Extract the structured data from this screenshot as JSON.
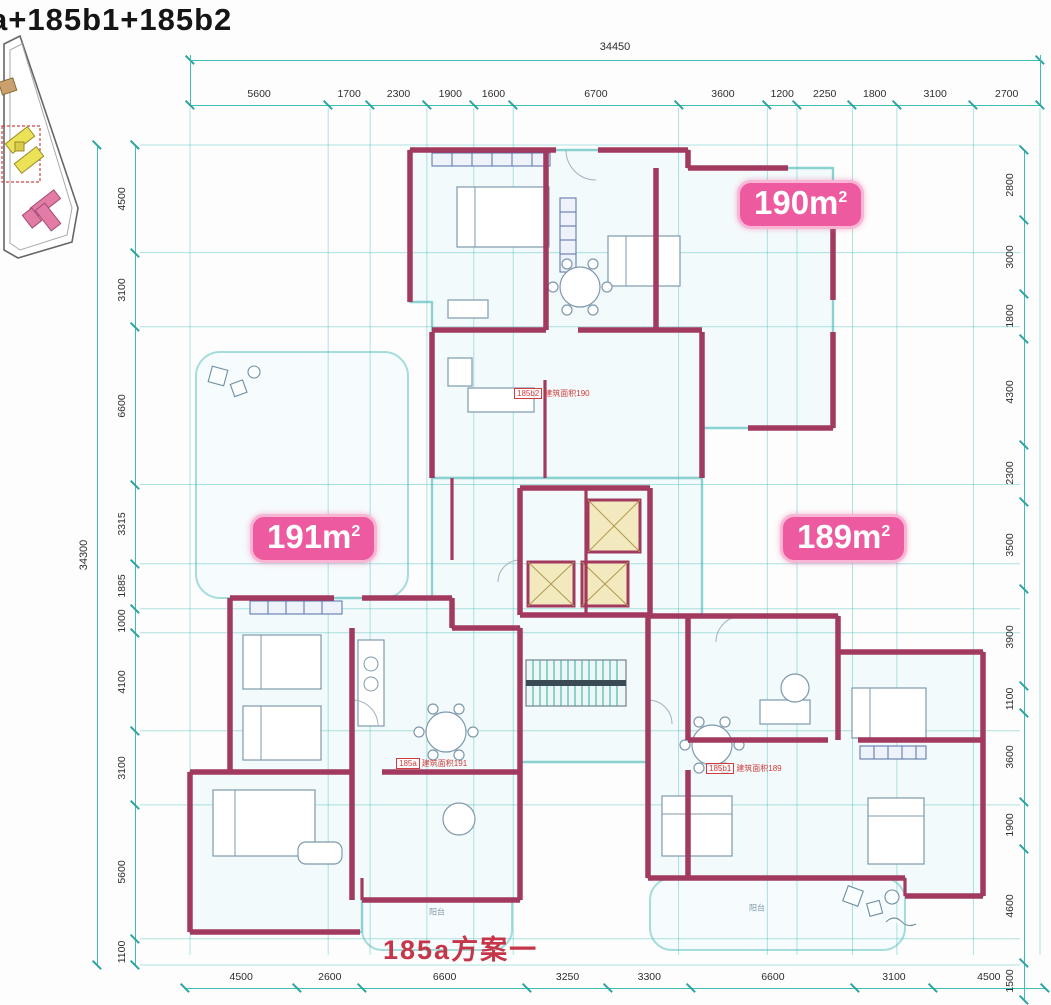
{
  "title": "a+185b1+185b2",
  "plan_name": "185a方案一",
  "badges": [
    {
      "text": "190m",
      "sup": "2"
    },
    {
      "text": "191m",
      "sup": "2"
    },
    {
      "text": "189m",
      "sup": "2"
    }
  ],
  "dimensions": {
    "top": {
      "total": 34450,
      "segments": [
        5600,
        1700,
        2300,
        1900,
        1600,
        6700,
        3600,
        1200,
        2250,
        1800,
        3100,
        2700
      ]
    },
    "bottom": {
      "segments": [
        4500,
        2600,
        6600,
        3250,
        3300,
        6600,
        3100,
        4500
      ]
    },
    "left": {
      "total": 34300,
      "segments": [
        4500,
        3100,
        6600,
        3315,
        1885,
        1000,
        4100,
        3100,
        5600,
        1100
      ]
    },
    "right": {
      "segments": [
        2800,
        3000,
        1800,
        4300,
        2300,
        3500,
        3900,
        1100,
        3600,
        1900,
        4600,
        1500
      ]
    }
  },
  "unit_labels": [
    {
      "tag": "185b2",
      "note": "建筑面积190"
    },
    {
      "tag": "185a",
      "note": "建筑面积191"
    },
    {
      "tag": "185b1",
      "note": "建筑面积189"
    }
  ],
  "room_labels": {
    "balcony": "阳台"
  },
  "colors": {
    "wall": "#a23a5f",
    "grid": "#3fbdb7",
    "badge": "#ee5a9f",
    "red": "#d03c3c",
    "yellow": "#f3e9bf"
  }
}
